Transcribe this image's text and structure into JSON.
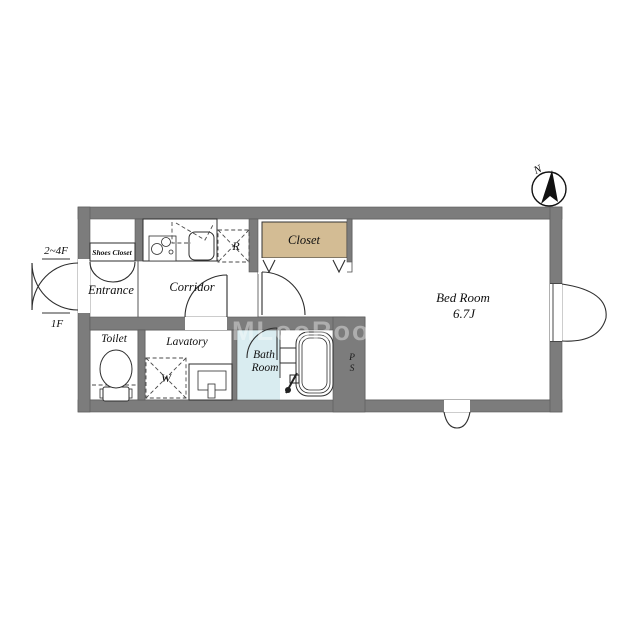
{
  "plan": {
    "compass_label": "N",
    "watermark": "MLooRooM",
    "floors": {
      "upper": "2~4F",
      "lower": "1F"
    },
    "rooms": {
      "entrance": "Entrance",
      "shoes_closet": "Shoes Closet",
      "corridor": "Corridor",
      "closet": "Closet",
      "bedroom": {
        "name": "Bed Room",
        "size": "6.7J"
      },
      "toilet": "Toilet",
      "lavatory": "Lavatory",
      "bath": {
        "line1": "Bath",
        "line2": "Room"
      }
    },
    "marks": {
      "refrigerator": "R",
      "washer": "W",
      "pipe_space_p": "P",
      "pipe_space_s": "S"
    }
  },
  "colors": {
    "wall": "#7C7C7C",
    "bedroom_floor": "#FBF7DF",
    "closet_floor": "#D3BC94",
    "wet_floor": "#D9ECF0"
  }
}
